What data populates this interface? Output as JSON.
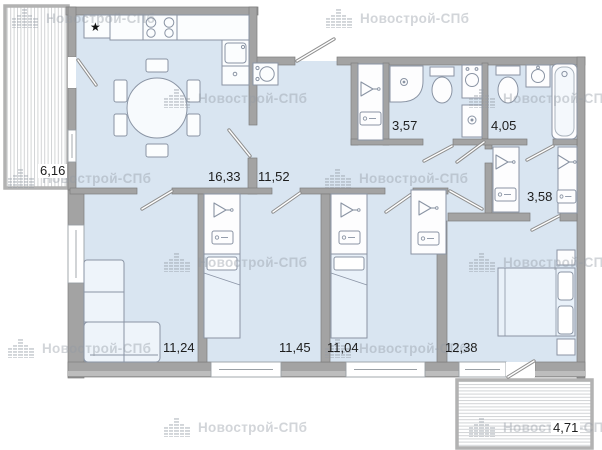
{
  "watermark": {
    "text": "Новострой-СПб"
  },
  "symbols": {
    "fridge_star": "★"
  },
  "rooms": [
    {
      "name": "balcony-top-left",
      "area": "6,16"
    },
    {
      "name": "kitchen-dining",
      "area": "16,33"
    },
    {
      "name": "hallway",
      "area": "11,52"
    },
    {
      "name": "bathroom-shower",
      "area": "3,57"
    },
    {
      "name": "bathroom-tub",
      "area": "4,05"
    },
    {
      "name": "wardrobe-hall",
      "area": "3,58"
    },
    {
      "name": "living-room",
      "area": "11,24"
    },
    {
      "name": "bedroom-1",
      "area": "11,45"
    },
    {
      "name": "bedroom-2",
      "area": "11,04"
    },
    {
      "name": "bedroom-3",
      "area": "12,38"
    },
    {
      "name": "balcony-bottom-right",
      "area": "4,71"
    }
  ],
  "colors": {
    "floor": "#d9e5f1",
    "wall": "#a3a3a3",
    "fixture_outline": "#8a94a4",
    "label": "#1d1d1d",
    "watermark": "#c9ced4"
  }
}
